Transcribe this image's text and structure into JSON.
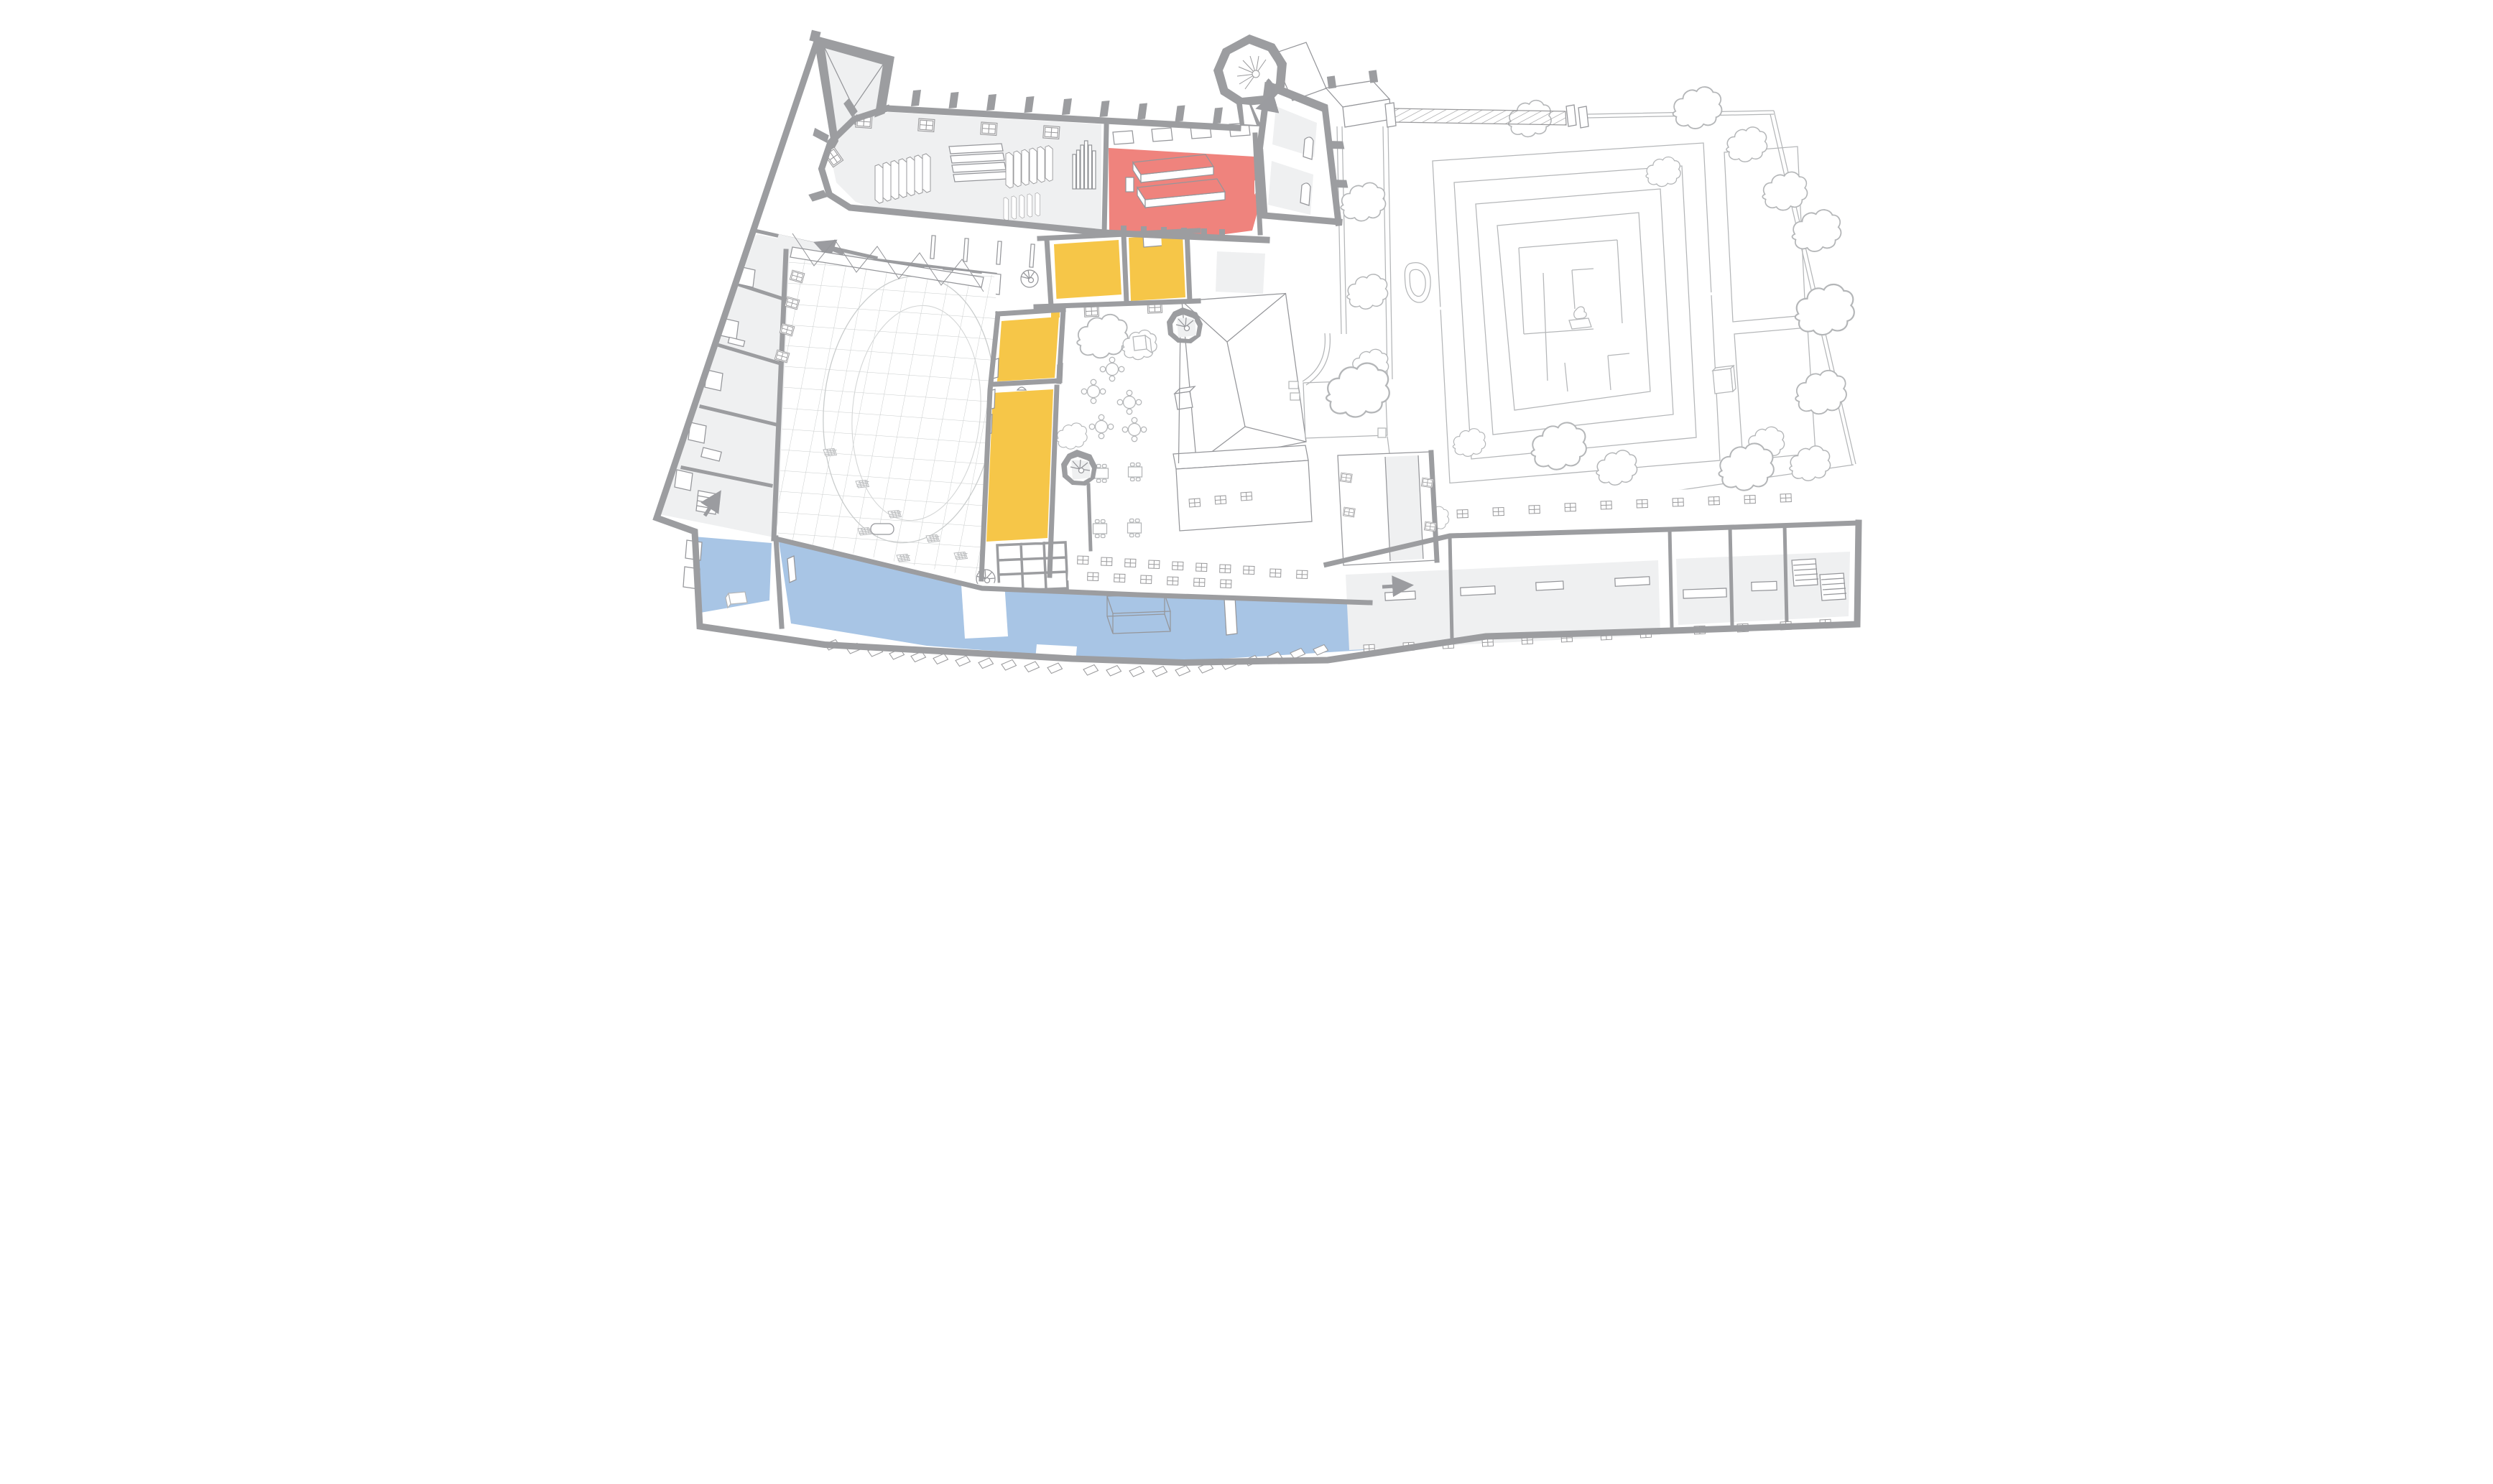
{
  "figure": {
    "kind": "axonometric cutaway floor-plan illustration of a historic building complex with formal garden",
    "visible_text": [],
    "legend_present": false
  },
  "palette": {
    "background": "#ffffff",
    "wall": "#9c9da0",
    "floor": "#eff0f1",
    "line": "#95969a",
    "line_light": "#b4b6b8",
    "hl_red": "#ef837d",
    "hl_yellow": "#f6c648",
    "hl_blue": "#a8c5e5",
    "arrow": "#9b9ca0"
  },
  "highlighted_zones": [
    {
      "id": "red-hall",
      "color": "#ef837d",
      "count": 1
    },
    {
      "id": "yellow-circulation-rooms",
      "color": "#f6c648",
      "count": 4
    },
    {
      "id": "blue-lower-rooms",
      "color": "#a8c5e5",
      "count": 2
    }
  ],
  "features": {
    "spiral_stair_turrets": 4,
    "direction_arrows": 5,
    "courtyard_round_tables": 5,
    "courtyard_square_tables": 4,
    "garden": {
      "parterre_maze": true,
      "pond": true,
      "trees_outlined": true
    },
    "chapel_pews": true,
    "red_room_tables": 2,
    "wireframe_box_in_blue_hall": true,
    "hatched_bridge_walkway": true
  }
}
